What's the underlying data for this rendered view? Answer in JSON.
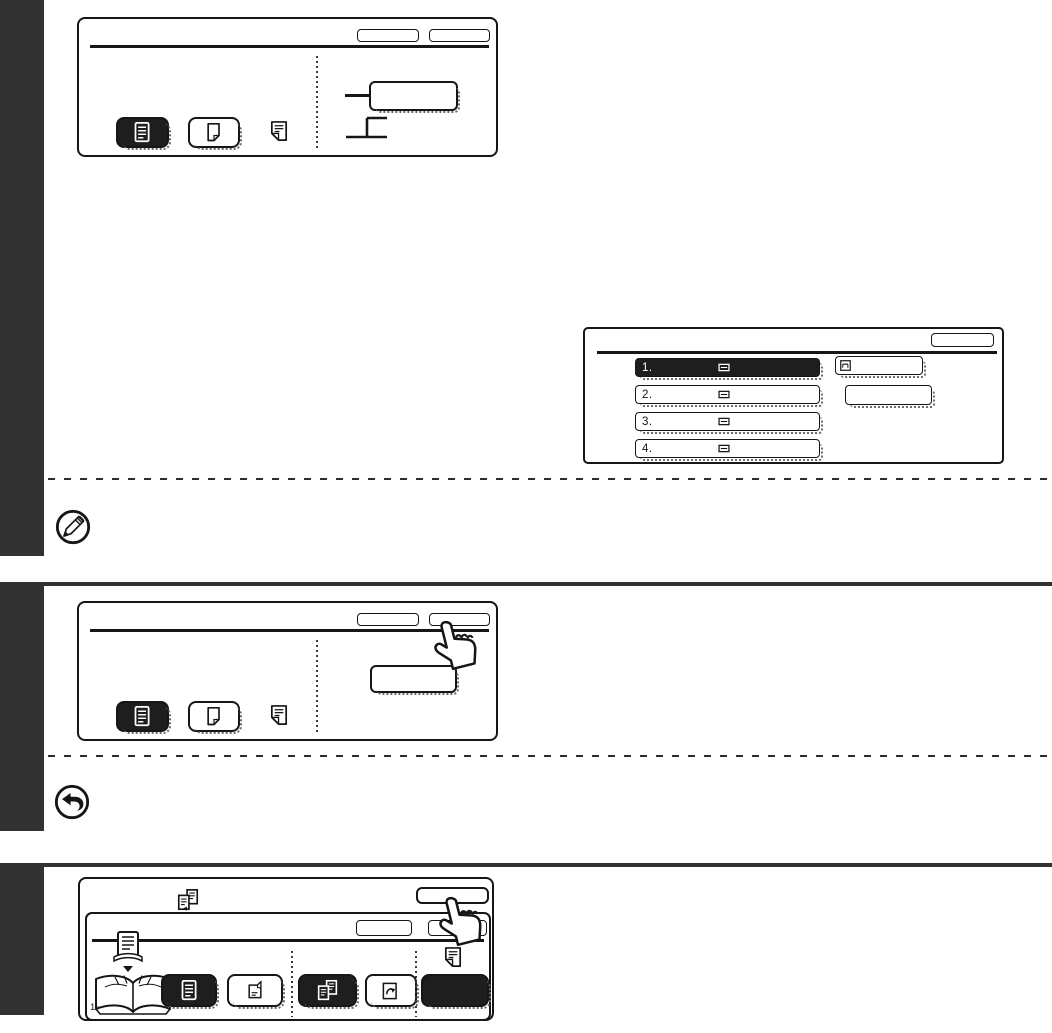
{
  "colors": {
    "page_bg": "#ffffff",
    "sidebar_bar": "#323232",
    "ink": "#161616",
    "selected_bg": "#1e1e1e",
    "selected_text": "#ffffff"
  },
  "list_screen": {
    "rows": [
      {
        "label": "1.",
        "selected": true
      },
      {
        "label": "2.",
        "selected": false
      },
      {
        "label": "3.",
        "selected": false
      },
      {
        "label": "4.",
        "selected": false
      }
    ]
  },
  "book_screen": {
    "page_range_label": "1~"
  },
  "icons": {
    "note_marker": "pencil-circle-icon",
    "go_back_marker": "return-arrow-circle-icon",
    "press_cursor": "hand-pointer-icon",
    "mode_selected": "document-text-icon",
    "mode_unselected": "blank-page-icon",
    "program": "folded-document-icon",
    "list_row_glyph": "paper-tray-icon",
    "list_action_glyph": "hand-feed-icon",
    "book_header_glyph": "book-copy-icon",
    "original_flow": "document-stack-icon",
    "book_illustration": "open-book-icon",
    "page_fold": "page-fold-icon",
    "page_insert": "page-insert-icon"
  }
}
